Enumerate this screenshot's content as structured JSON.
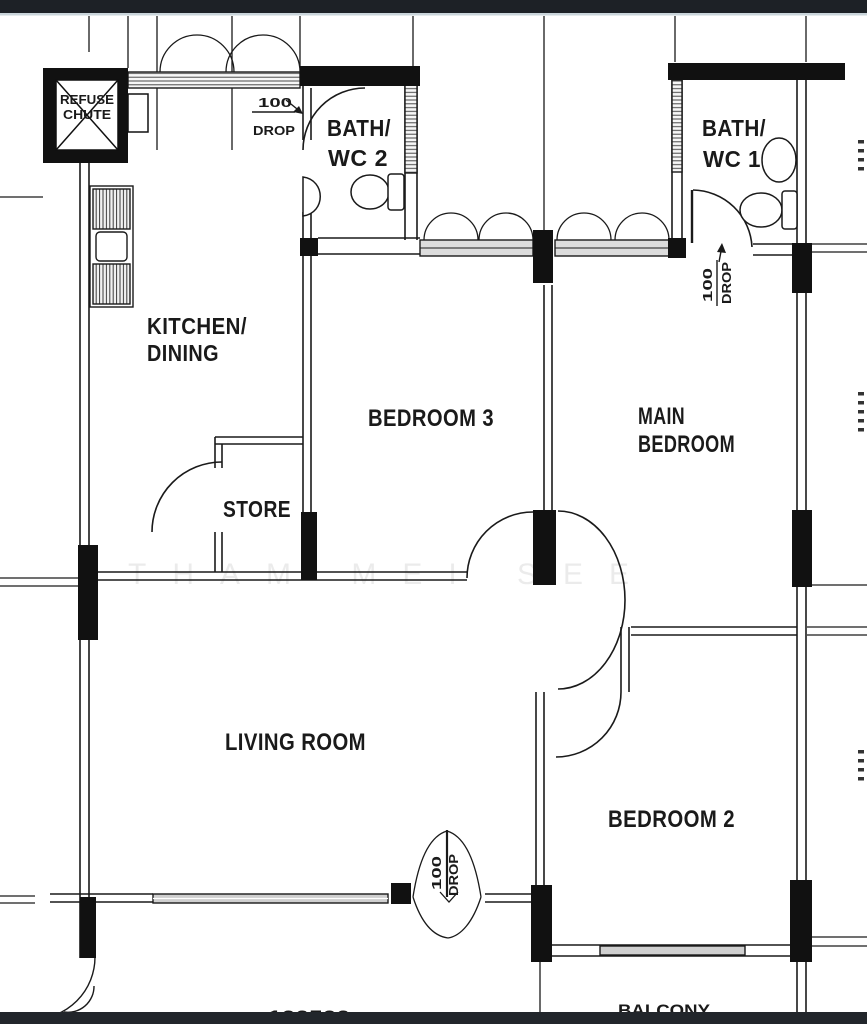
{
  "meta": {
    "width": 867,
    "height": 1024,
    "type": "floor-plan"
  },
  "colors": {
    "top_bar": "#1d2126",
    "top_bar_edge": "#c9d4da",
    "bottom_bar": "#22262b",
    "ink": "#1a1a1a",
    "band_fill": "#dcdcdc",
    "watermark": "rgba(0,0,0,0.08)",
    "paper": "#ffffff"
  },
  "rooms": {
    "refuse_chute_line1": "REFUSE",
    "refuse_chute_line2": "CHUTE",
    "kitchen_line1": "KITCHEN/",
    "kitchen_line2": "DINING",
    "bath2_line1": "BATH/",
    "bath2_line2": "WC 2",
    "bath1_line1": "BATH/",
    "bath1_line2": "WC 1",
    "bedroom3": "BEDROOM 3",
    "main_bedroom_line1": "MAIN",
    "main_bedroom_line2": "BEDROOM",
    "store": "STORE",
    "living_room": "LIVING ROOM",
    "bedroom2": "BEDROOM 2",
    "balcony": "BALCONY"
  },
  "annotations": {
    "drop_num": "100",
    "drop_word": "DROP",
    "partial_dimension": "100500",
    "watermark": "THAM MEI SEE"
  }
}
